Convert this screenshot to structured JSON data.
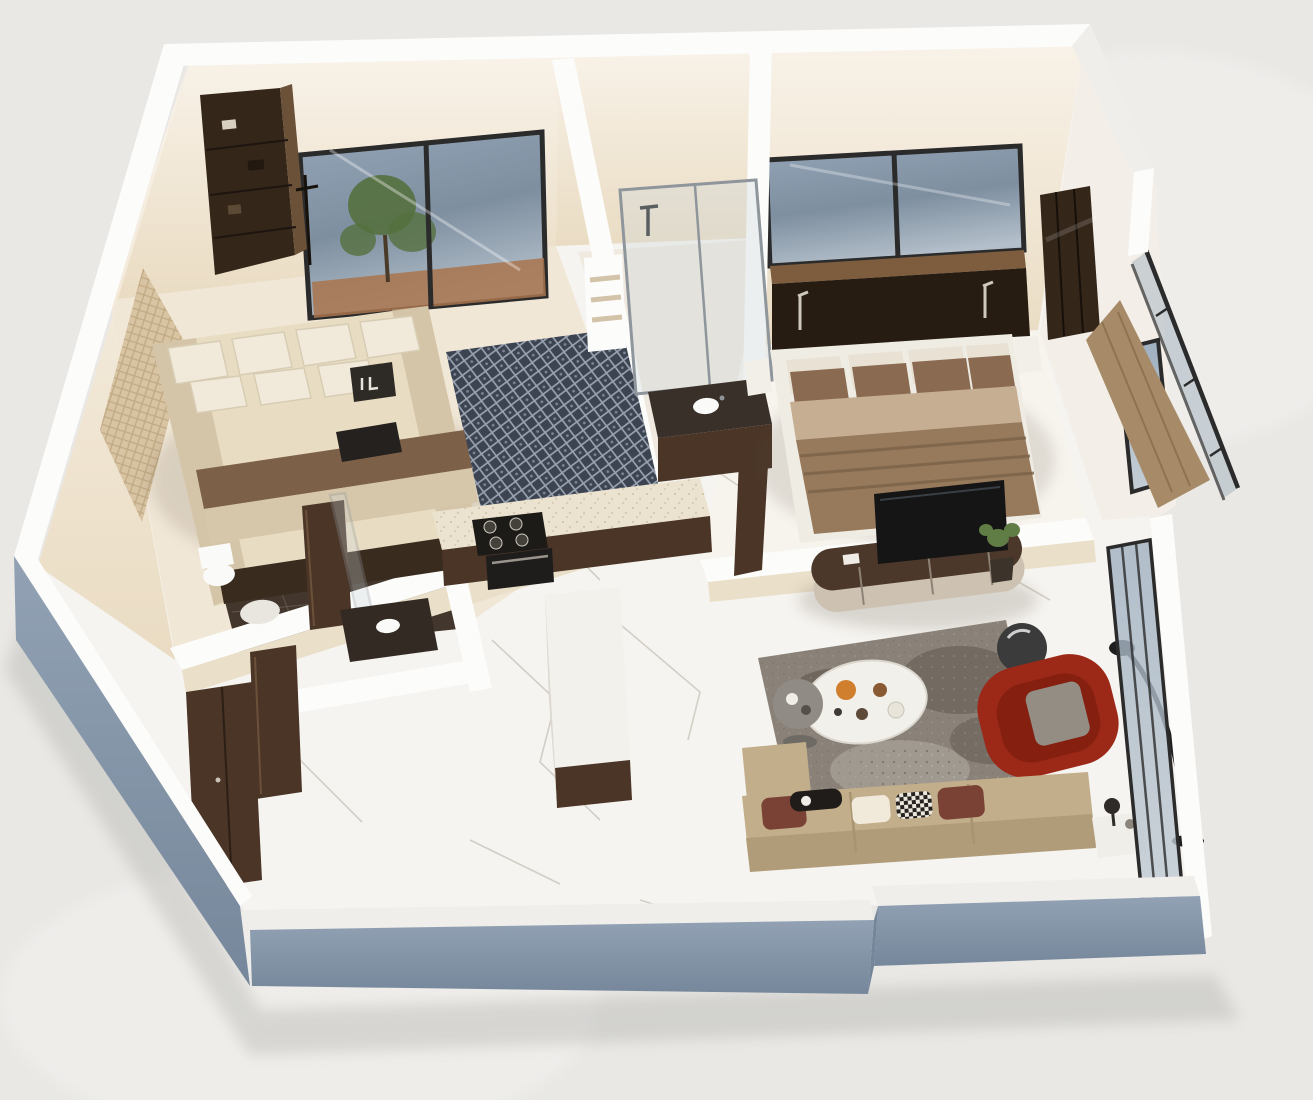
{
  "scene": {
    "type": "isometric-3d-floor-plan-render",
    "visible_text": [],
    "background": "#e9e8e5"
  },
  "colors": {
    "background": "#e9e8e5",
    "bg_spot": "#f3f2f0",
    "ground_shadow": "#9a9a96",
    "wall_cap": "#fcfcfb",
    "wall_cap_shade": "#f0eeea",
    "wall_lit": "#f3efe8",
    "wall_interior": "#f7f0e4",
    "wall_interior_shade": "#eadfc9",
    "wall_exterior": "#8496a9",
    "wall_exterior_dark": "#75869a",
    "floor_marble": "#f6f4f0",
    "floor_vein": "#ccc8c0",
    "floor_bedroom": "#f1e7d6",
    "floor_bath": "#43372d",
    "floor_bath2": "#efe9df",
    "grout": "#706356",
    "wood_dark": "#4a3527",
    "wood_darker": "#35261a",
    "wood_mid": "#6a5138",
    "counter_beige": "#ebe3d0",
    "island_white": "#f3f1ec",
    "hob_black": "#1d1b18",
    "bed1_mattress": "#e8dcc2",
    "bed1_stripe": "#7c6048",
    "bed1_fold": "#d6c6aa",
    "pillow_white": "#f1eadb",
    "rug1_base": "#3c4351",
    "rug1_line": "#9aa3b1",
    "bed2_duvet": "#97795c",
    "bed2_sheet": "#c6ae92",
    "bed2_pillow": "#8a6b52",
    "headboard_dark": "#271c12",
    "window_frame": "#2b2b2b",
    "sill_brown": "#7d5d3e",
    "tree_green": "#55703f",
    "terracotta": "#a9744d",
    "tv_black": "#151515",
    "console_top": "#4c382a",
    "console_face": "#cdc2b2",
    "rug2_base": "#8a8279",
    "rug2_dark": "#5b534b",
    "rug2_light": "#b6afa6",
    "table_white": "#f2f0ea",
    "side_table_gray": "#908c85",
    "armchair_red": "#9c2817",
    "armchair_red_dark": "#851f10",
    "cushion_gray": "#948d84",
    "sofa_base": "#c2ae8b",
    "sofa_back": "#b09c79",
    "pillow_maroon": "#7a4234",
    "lamp_black": "#1e1e1e",
    "plant_green": "#5f7d45",
    "glass": "#aab7c1",
    "glass_dark": "#7e8fa0",
    "steel": "#8e959b",
    "porcelain": "#fafaf8",
    "food_orange": "#cf7f2e",
    "food_brown": "#8a5a33"
  }
}
